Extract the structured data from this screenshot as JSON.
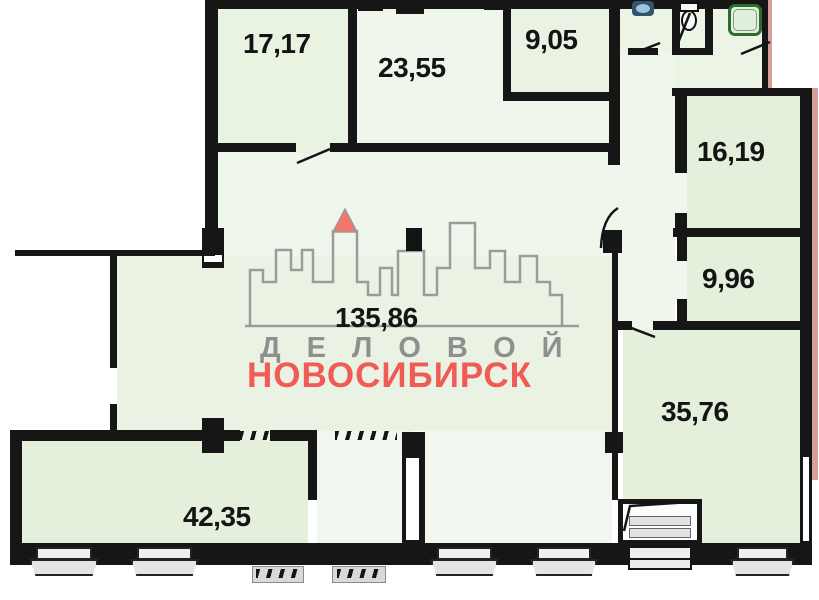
{
  "plan_title": "Commercial floor plan with room areas (m²)",
  "rooms": [
    {
      "id": "room-17-17",
      "area": "17,17"
    },
    {
      "id": "room-23-55",
      "area": "23,55"
    },
    {
      "id": "room-9-05",
      "area": "9,05"
    },
    {
      "id": "room-16-19",
      "area": "16,19"
    },
    {
      "id": "room-9-96",
      "area": "9,96"
    },
    {
      "id": "room-135-86",
      "area": "135,86"
    },
    {
      "id": "room-35-76",
      "area": "35,76"
    },
    {
      "id": "room-42-35",
      "area": "42,35"
    }
  ],
  "watermark": {
    "top_word": "ДЕЛОВОЙ",
    "bottom_word": "НОВОСИБИРСК"
  },
  "fixtures": [
    "sink",
    "toilet",
    "shower"
  ],
  "colors": {
    "room_fill": "#e6f1df",
    "room_fill_light": "#eff6eb",
    "wall": "#161616",
    "watermark_gray": "#8f8f8f",
    "watermark_red": "#f15b55",
    "roof_red": "#f2766b",
    "shower_green": "#2f6b2f",
    "exterior_pink": "#d8a09a"
  }
}
